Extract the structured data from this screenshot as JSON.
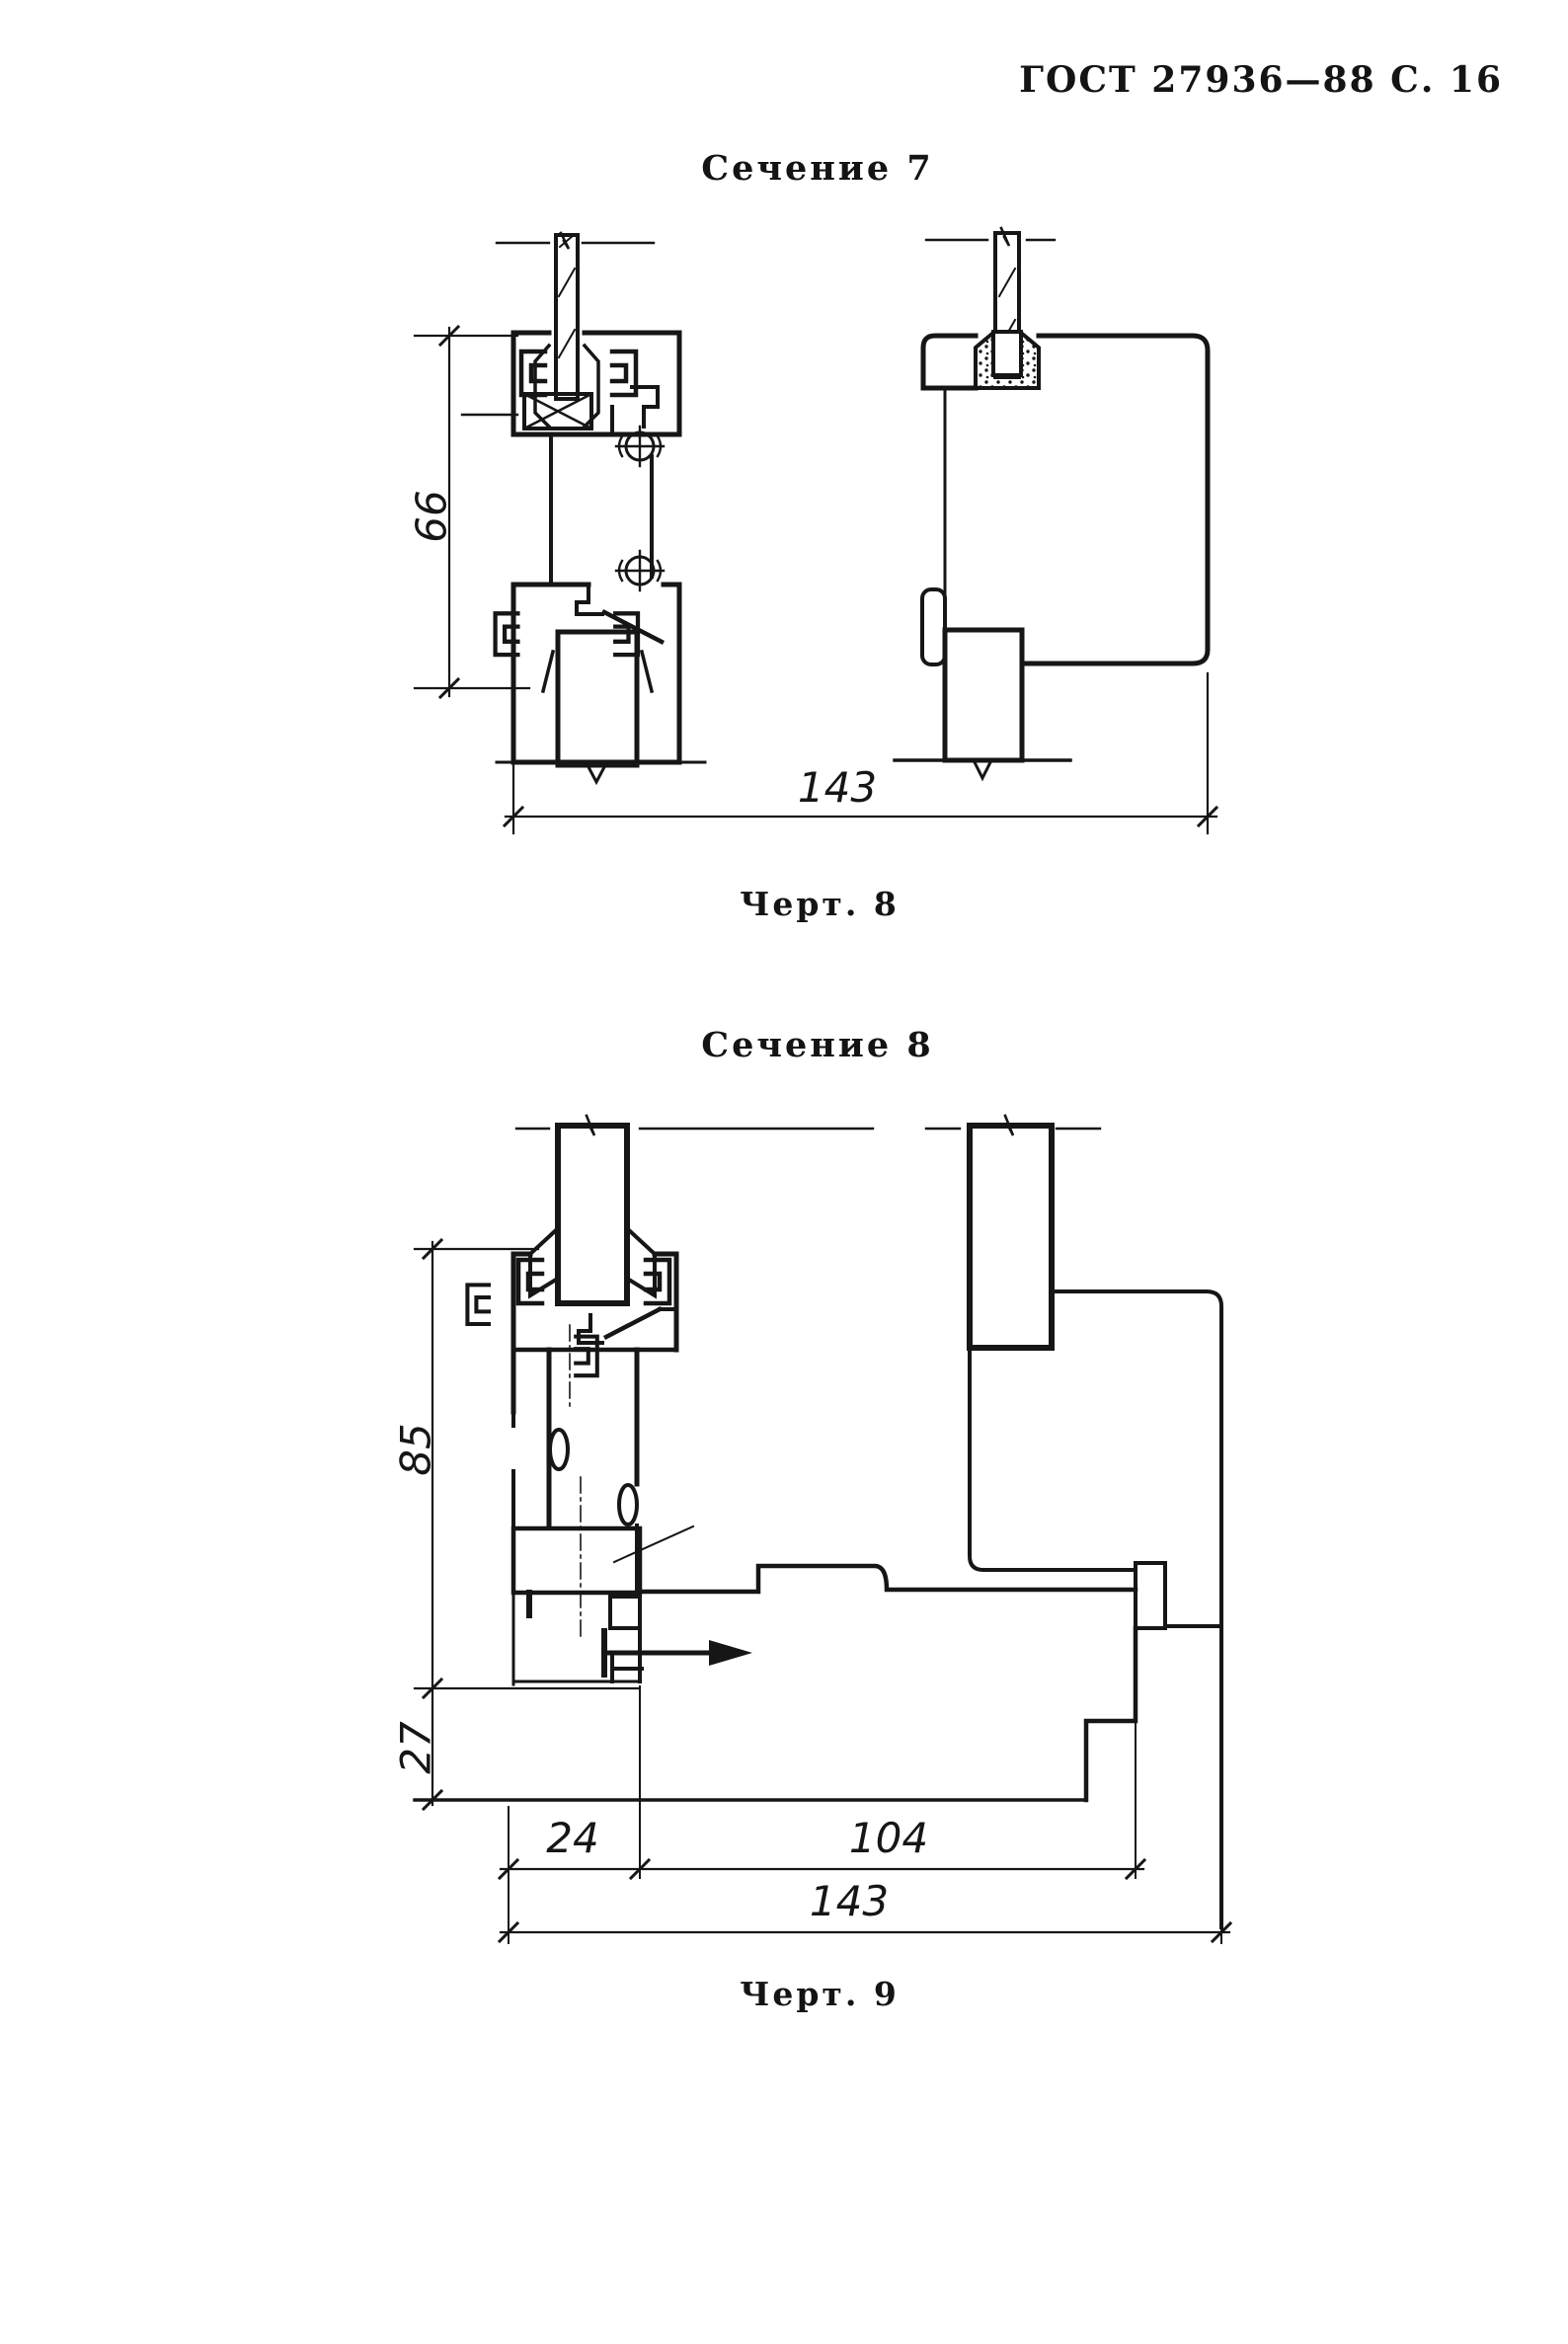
{
  "header": {
    "title": "ГОСТ 27936—88 С. 16"
  },
  "figure1": {
    "section_title": "Сечение 7",
    "caption": "Черт. 8",
    "dims": {
      "height": "66",
      "width_total": "143"
    }
  },
  "figure2": {
    "section_title": "Сечение 8",
    "caption": "Черт. 9",
    "dims": {
      "height_upper": "85",
      "height_lower": "27",
      "width_left": "24",
      "width_mid": "104",
      "width_total": "143"
    }
  }
}
